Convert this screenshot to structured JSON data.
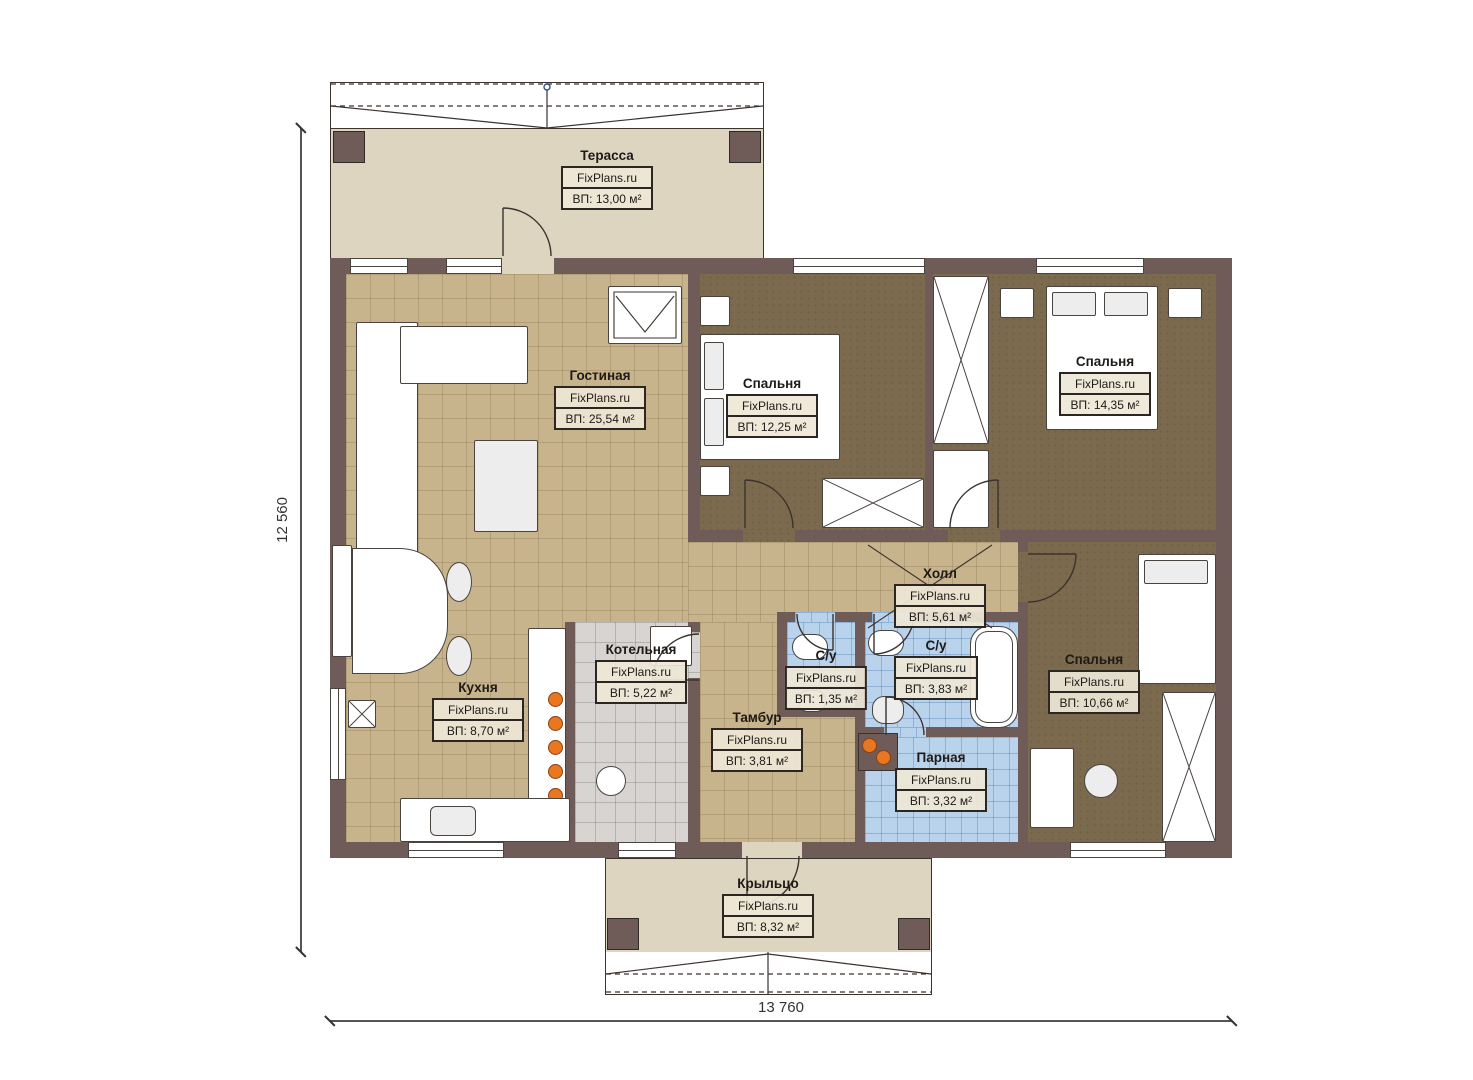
{
  "plan": {
    "brand": "FixPlans.ru",
    "type": "single-storey house floor plan"
  },
  "dimensions": {
    "bottom": "13 760",
    "left": "12 560"
  },
  "rooms": [
    {
      "id": "terrace",
      "name": "Терасса",
      "brand": "FixPlans.ru",
      "area": "ВП: 13,00 м²"
    },
    {
      "id": "living",
      "name": "Гостиная",
      "brand": "FixPlans.ru",
      "area": "ВП: 25,54 м²"
    },
    {
      "id": "bedroom1",
      "name": "Спальня",
      "brand": "FixPlans.ru",
      "area": "ВП: 12,25 м²"
    },
    {
      "id": "bedroom2",
      "name": "Спальня",
      "brand": "FixPlans.ru",
      "area": "ВП: 14,35 м²"
    },
    {
      "id": "hall",
      "name": "Холл",
      "brand": "FixPlans.ru",
      "area": "ВП: 5,61 м²"
    },
    {
      "id": "kitchen",
      "name": "Кухня",
      "brand": "FixPlans.ru",
      "area": "ВП: 8,70 м²"
    },
    {
      "id": "boiler",
      "name": "Котельная",
      "brand": "FixPlans.ru",
      "area": "ВП: 5,22 м²"
    },
    {
      "id": "wc-small",
      "name": "С/у",
      "brand": "FixPlans.ru",
      "area": "ВП: 1,35 м²"
    },
    {
      "id": "wc-large",
      "name": "С/у",
      "brand": "FixPlans.ru",
      "area": "ВП: 3,83 м²"
    },
    {
      "id": "tambur",
      "name": "Тамбур",
      "brand": "FixPlans.ru",
      "area": "ВП: 3,81 м²"
    },
    {
      "id": "steam",
      "name": "Парная",
      "brand": "FixPlans.ru",
      "area": "ВП: 3,32 м²"
    },
    {
      "id": "bedroom3",
      "name": "Спальня",
      "brand": "FixPlans.ru",
      "area": "ВП: 10,66 м²"
    },
    {
      "id": "porch",
      "name": "Крыльцо",
      "brand": "FixPlans.ru",
      "area": "ВП: 8,32 м²"
    }
  ],
  "colors": {
    "wall": "#6f5b58",
    "tile_tan": "#c8b48c",
    "floor_dark": "#7b6a4d",
    "tile_blue": "#b9d3ec",
    "tile_gray": "#d7d4d1",
    "deck": "#ded5c1",
    "accent_orange": "#e87722"
  }
}
